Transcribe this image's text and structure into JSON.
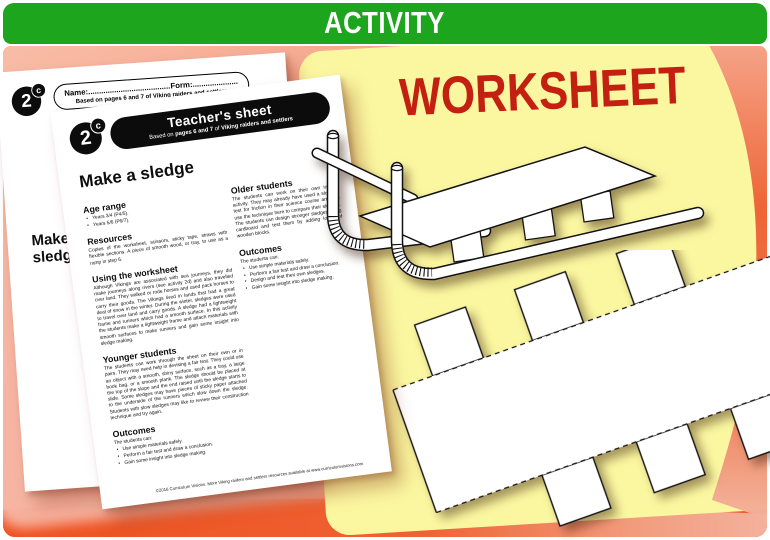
{
  "header": {
    "title": "ACTIVITY"
  },
  "overlay": {
    "worksheet_label": "WORKSHEET"
  },
  "colors": {
    "header_green": "#1ea51e",
    "background_orange": "#ee5b2b",
    "panel_yellow": "#fbf7a0",
    "worksheet_red": "#c32012"
  },
  "student_sheet": {
    "badge": {
      "number": "2",
      "letter": "c"
    },
    "name_label": "Name:",
    "name_dots": "......................................................",
    "form_label": "Form:",
    "form_dots": ".....................",
    "based_on": "Based on pages 6 and 7 of Viking raiders and settlers",
    "title": "Make a sledge",
    "copyright": "©2016 Curriculum Visions"
  },
  "teacher_sheet": {
    "badge": {
      "number": "2",
      "letter": "c"
    },
    "banner": {
      "title": "Teacher's sheet",
      "based_prefix": "Based on ",
      "based_pages": "pages 6 and 7",
      "based_of": " of ",
      "based_book": "Viking raiders and settlers"
    },
    "title": "Make a sledge",
    "age_range": {
      "heading": "Age range",
      "items": [
        "Years 3/4 (P4/5).",
        "Years 5/6 (P6/7)."
      ]
    },
    "resources": {
      "heading": "Resources",
      "text": "Copies of the worksheet, scissors, sticky tape, straws with flexible sections. A piece of smooth wood, or tray, to use as a ramp in step 6."
    },
    "using": {
      "heading": "Using the worksheet",
      "text": "Although Vikings are associated with sea journeys, they did make journeys along rivers (see activity 2d) and also travelled over land. They walked or rode horses and used pack horses to carry their goods. The Vikings lived in lands that had a great deal of snow in the winter. During the winter, sledges were used to travel over land and carry goods. A sledge had a lightweight frame and runners which had a smooth surface. In this activity the students make a lightweight frame and attach materials with smooth surfaces to make runners and gain some insight into sledge making."
    },
    "younger": {
      "heading": "Younger students",
      "text": "The students can work through the sheet on their own or in pairs. They may need help in devising a fair test. They could use an object with a smooth, shiny surface, such as a tray, a large book bag, or a smooth plank. The sledge should be placed at the top of the slope and the end raised until the sledge starts to slide. Some sledges may have pieces of sticky paper attached to the underside of the runners which slow down the sledge. Students with slow sledges may like to review their construction technique and try again."
    },
    "outcomes": {
      "heading": "Outcomes",
      "intro": "The students can:",
      "items": [
        "Use simple materials safely.",
        "Perform a fair test and draw a conclusion.",
        "Gain some insight into sledge making."
      ]
    },
    "older": {
      "heading": "Older students",
      "text": "The students can work on their own in this activity. They may already have used a slope to test for friction in their science course and can use the technique here to compare their sledges. The students can design stronger sledges using cardboard and test them by adding loads of wooden blocks."
    },
    "older_outcomes": {
      "heading": "Outcomes",
      "intro": "The students can:",
      "items": [
        "Use simple materials safely.",
        "Perform a fair test and draw a conclusion.",
        "Design and test their own sledges.",
        "Gain some insight into sledge making."
      ]
    },
    "copyright": "©2016 Curriculum Visions. More Viking raiders and settlers resources available at www.curriculumvisions.com"
  }
}
